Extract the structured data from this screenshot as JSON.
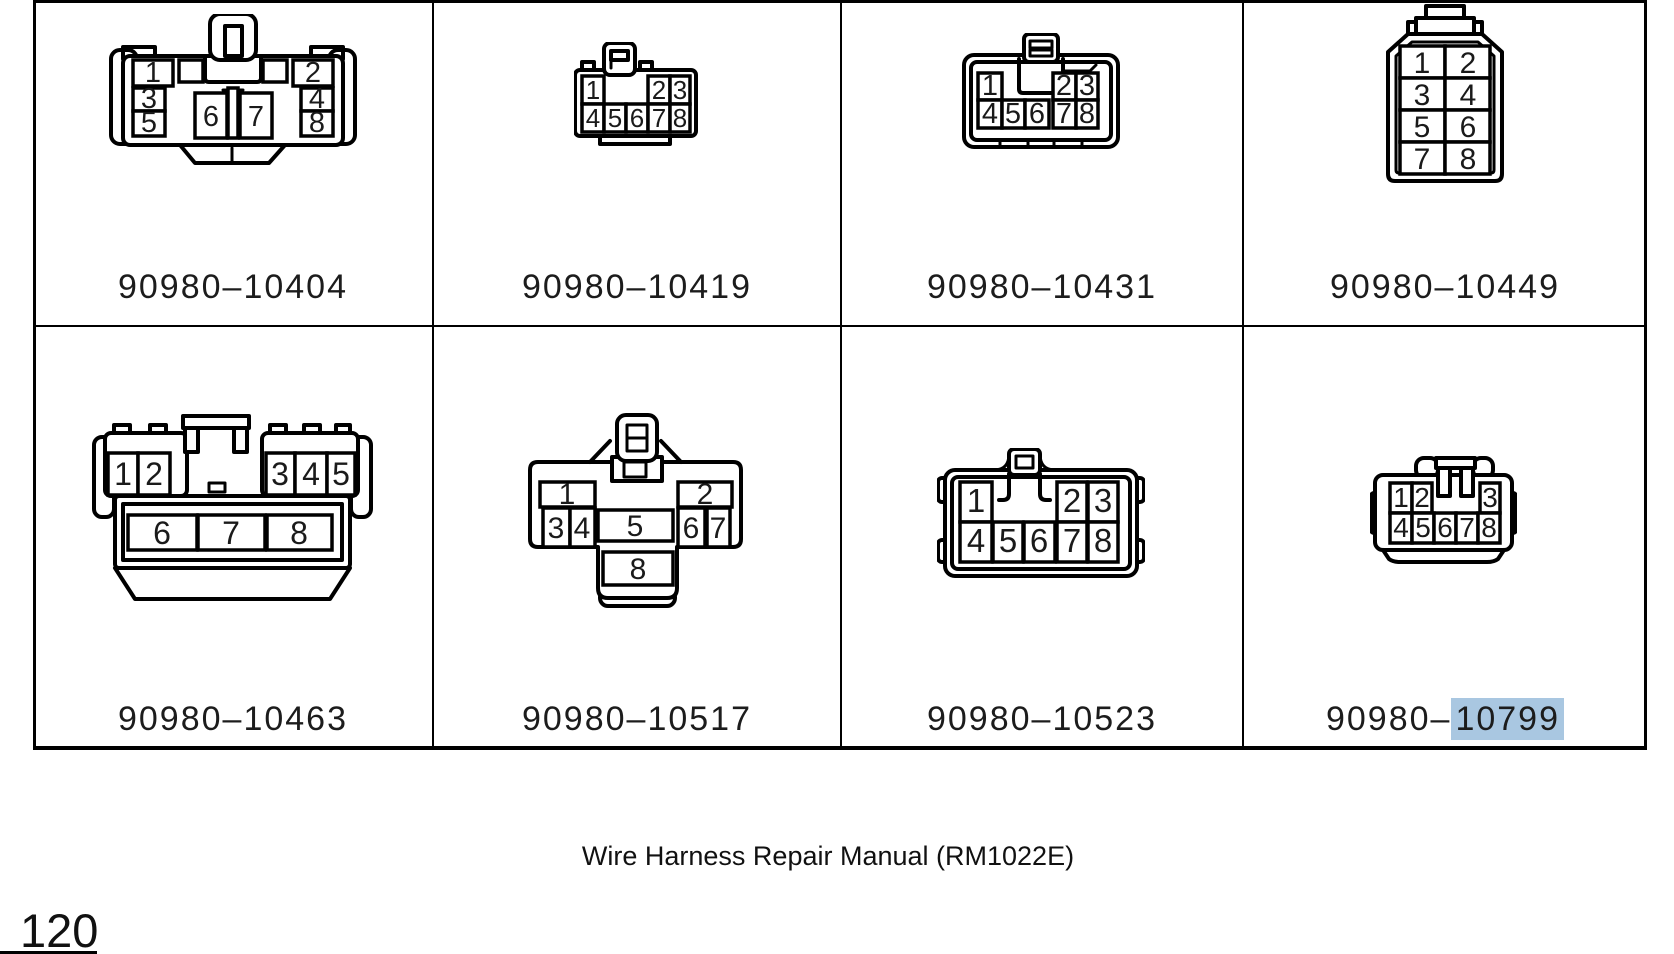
{
  "page": {
    "footer_text": "Wire Harness Repair Manual (RM1022E)",
    "page_number": "120"
  },
  "highlight": {
    "color": "#a9c7e1",
    "highlighted_text": "10799"
  },
  "connectors": [
    {
      "label_prefix": "90980–",
      "label_suffix": "10404",
      "pins": {
        "left": [
          "1",
          "3",
          "5"
        ],
        "center": [
          "6",
          "7"
        ],
        "right": [
          "2",
          "4",
          "8"
        ]
      }
    },
    {
      "label_prefix": "90980–",
      "label_suffix": "10419",
      "pins": {
        "top": [
          "1",
          "2",
          "3"
        ],
        "bottom": [
          "4",
          "5",
          "6",
          "7",
          "8"
        ]
      }
    },
    {
      "label_prefix": "90980–",
      "label_suffix": "10431",
      "pins": {
        "top": [
          "1",
          "2",
          "3"
        ],
        "bottom": [
          "4",
          "5",
          "6",
          "7",
          "8"
        ]
      }
    },
    {
      "label_prefix": "90980–",
      "label_suffix": "10449",
      "pins": {
        "rows": [
          [
            "1",
            "2"
          ],
          [
            "3",
            "4"
          ],
          [
            "5",
            "6"
          ],
          [
            "7",
            "8"
          ]
        ]
      }
    },
    {
      "label_prefix": "90980–",
      "label_suffix": "10463",
      "pins": {
        "top": [
          "1",
          "2",
          "3",
          "4",
          "5"
        ],
        "bottom": [
          "6",
          "7",
          "8"
        ]
      }
    },
    {
      "label_prefix": "90980–",
      "label_suffix": "10517",
      "pins": {
        "top": [
          "1",
          "2"
        ],
        "middle": [
          "3",
          "4",
          "5",
          "6",
          "7"
        ],
        "bottom": [
          "8"
        ]
      }
    },
    {
      "label_prefix": "90980–",
      "label_suffix": "10523",
      "pins": {
        "top": [
          "1",
          "2",
          "3"
        ],
        "bottom": [
          "4",
          "5",
          "6",
          "7",
          "8"
        ]
      }
    },
    {
      "label_prefix": "90980–",
      "label_suffix": "10799",
      "pins": {
        "top": [
          "1",
          "2",
          "3"
        ],
        "bottom": [
          "4",
          "5",
          "6",
          "7",
          "8"
        ]
      }
    }
  ]
}
